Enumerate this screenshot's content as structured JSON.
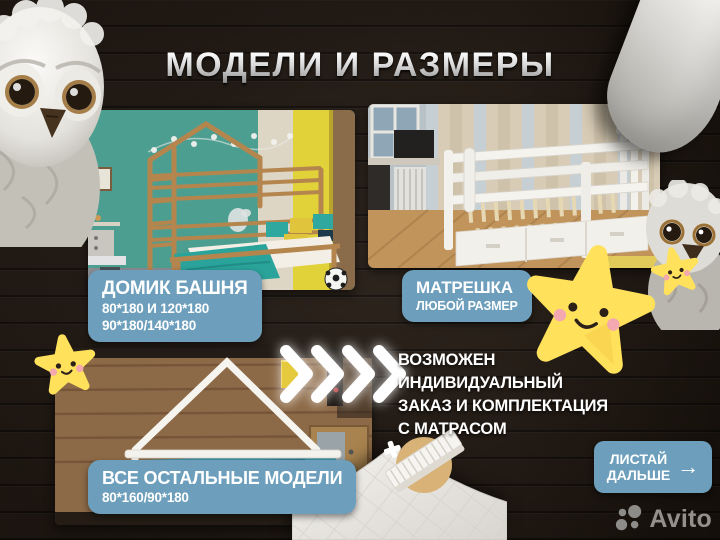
{
  "title": "МОДЕЛИ И РАЗМЕРЫ",
  "models": [
    {
      "name": "ДОМИК БАШНЯ",
      "size_lines": [
        "80*180 И 120*180",
        "90*180/140*180"
      ]
    },
    {
      "name": "МАТРЕШКА",
      "size_lines": [
        "ЛЮБОЙ РАЗМЕР"
      ]
    },
    {
      "name": "ВСЕ ОСТАЛЬНЫЕ МОДЕЛИ",
      "size_lines": [
        "80*160/90*180"
      ]
    }
  ],
  "note_lines": [
    "ВОЗМОЖЕН",
    "ИНДИВИДУАЛЬНЫЙ",
    "ЗАКАЗ И КОМПЛЕКТАЦИЯ",
    "С МАТРАСОМ"
  ],
  "cta": {
    "line1": "ЛИСТАЙ",
    "line2": "ДАЛЬШЕ",
    "arrow": "→"
  },
  "watermark": "Avito",
  "colors": {
    "badge": "#6d9fbc",
    "badge_text": "#ffffff",
    "background_wood": "#241b14",
    "star_yellow": "#ffe15c",
    "note_text": "#ffffff",
    "watermark_gray": "#93908c",
    "teal_wall": "#4c9f90",
    "wardrobe_yellow": "#e2d23a"
  },
  "icons": [
    "owl-plush-icon",
    "star-smiley-icon",
    "chevron-right-icon",
    "arrow-right-icon",
    "pillow-icon",
    "duvet-icon",
    "mattress-icon",
    "plus-icon",
    "soccer-ball-icon",
    "avito-logo-icon"
  ]
}
